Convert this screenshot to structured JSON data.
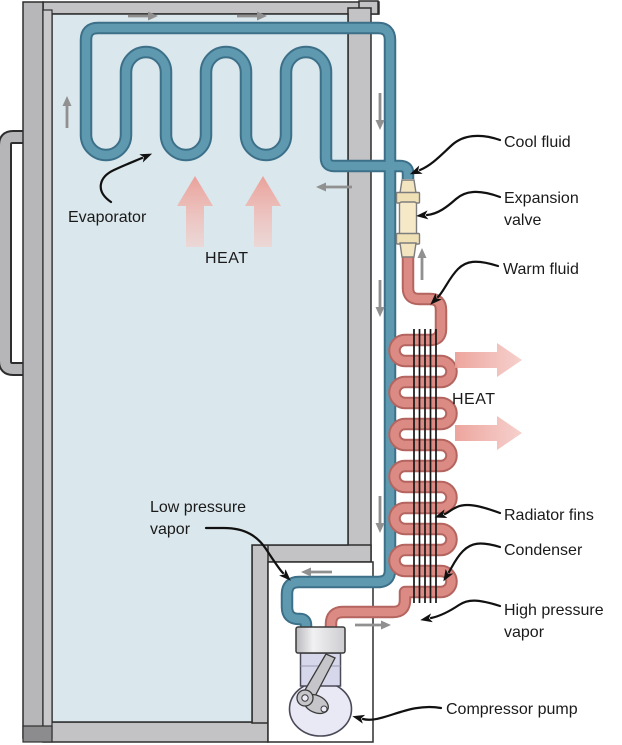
{
  "figure": {
    "labels": {
      "evaporator": "Evaporator",
      "heat_inside": "HEAT",
      "cool_fluid": "Cool fluid",
      "expansion_valve": "Expansion valve",
      "warm_fluid": "Warm fluid",
      "heat_outside": "HEAT",
      "radiator_fins": "Radiator fins",
      "condenser": "Condenser",
      "high_pressure_vapor": "High pressure vapor",
      "low_pressure_vapor": "Low pressure vapor",
      "compressor_pump": "Compressor pump"
    },
    "colors": {
      "cold_pipe": "#5f99af",
      "cold_pipe_edge": "#3c7089",
      "hot_pipe": "#db8a84",
      "hot_pipe_edge": "#b5655f",
      "heat_arrow_pink": "#eb9d95",
      "fridge_gray": "#c3c3c5",
      "interior_blue": "#dae7ec",
      "valve_cream": "#f2e5c0",
      "flow_arrow_gray": "#909090"
    }
  }
}
